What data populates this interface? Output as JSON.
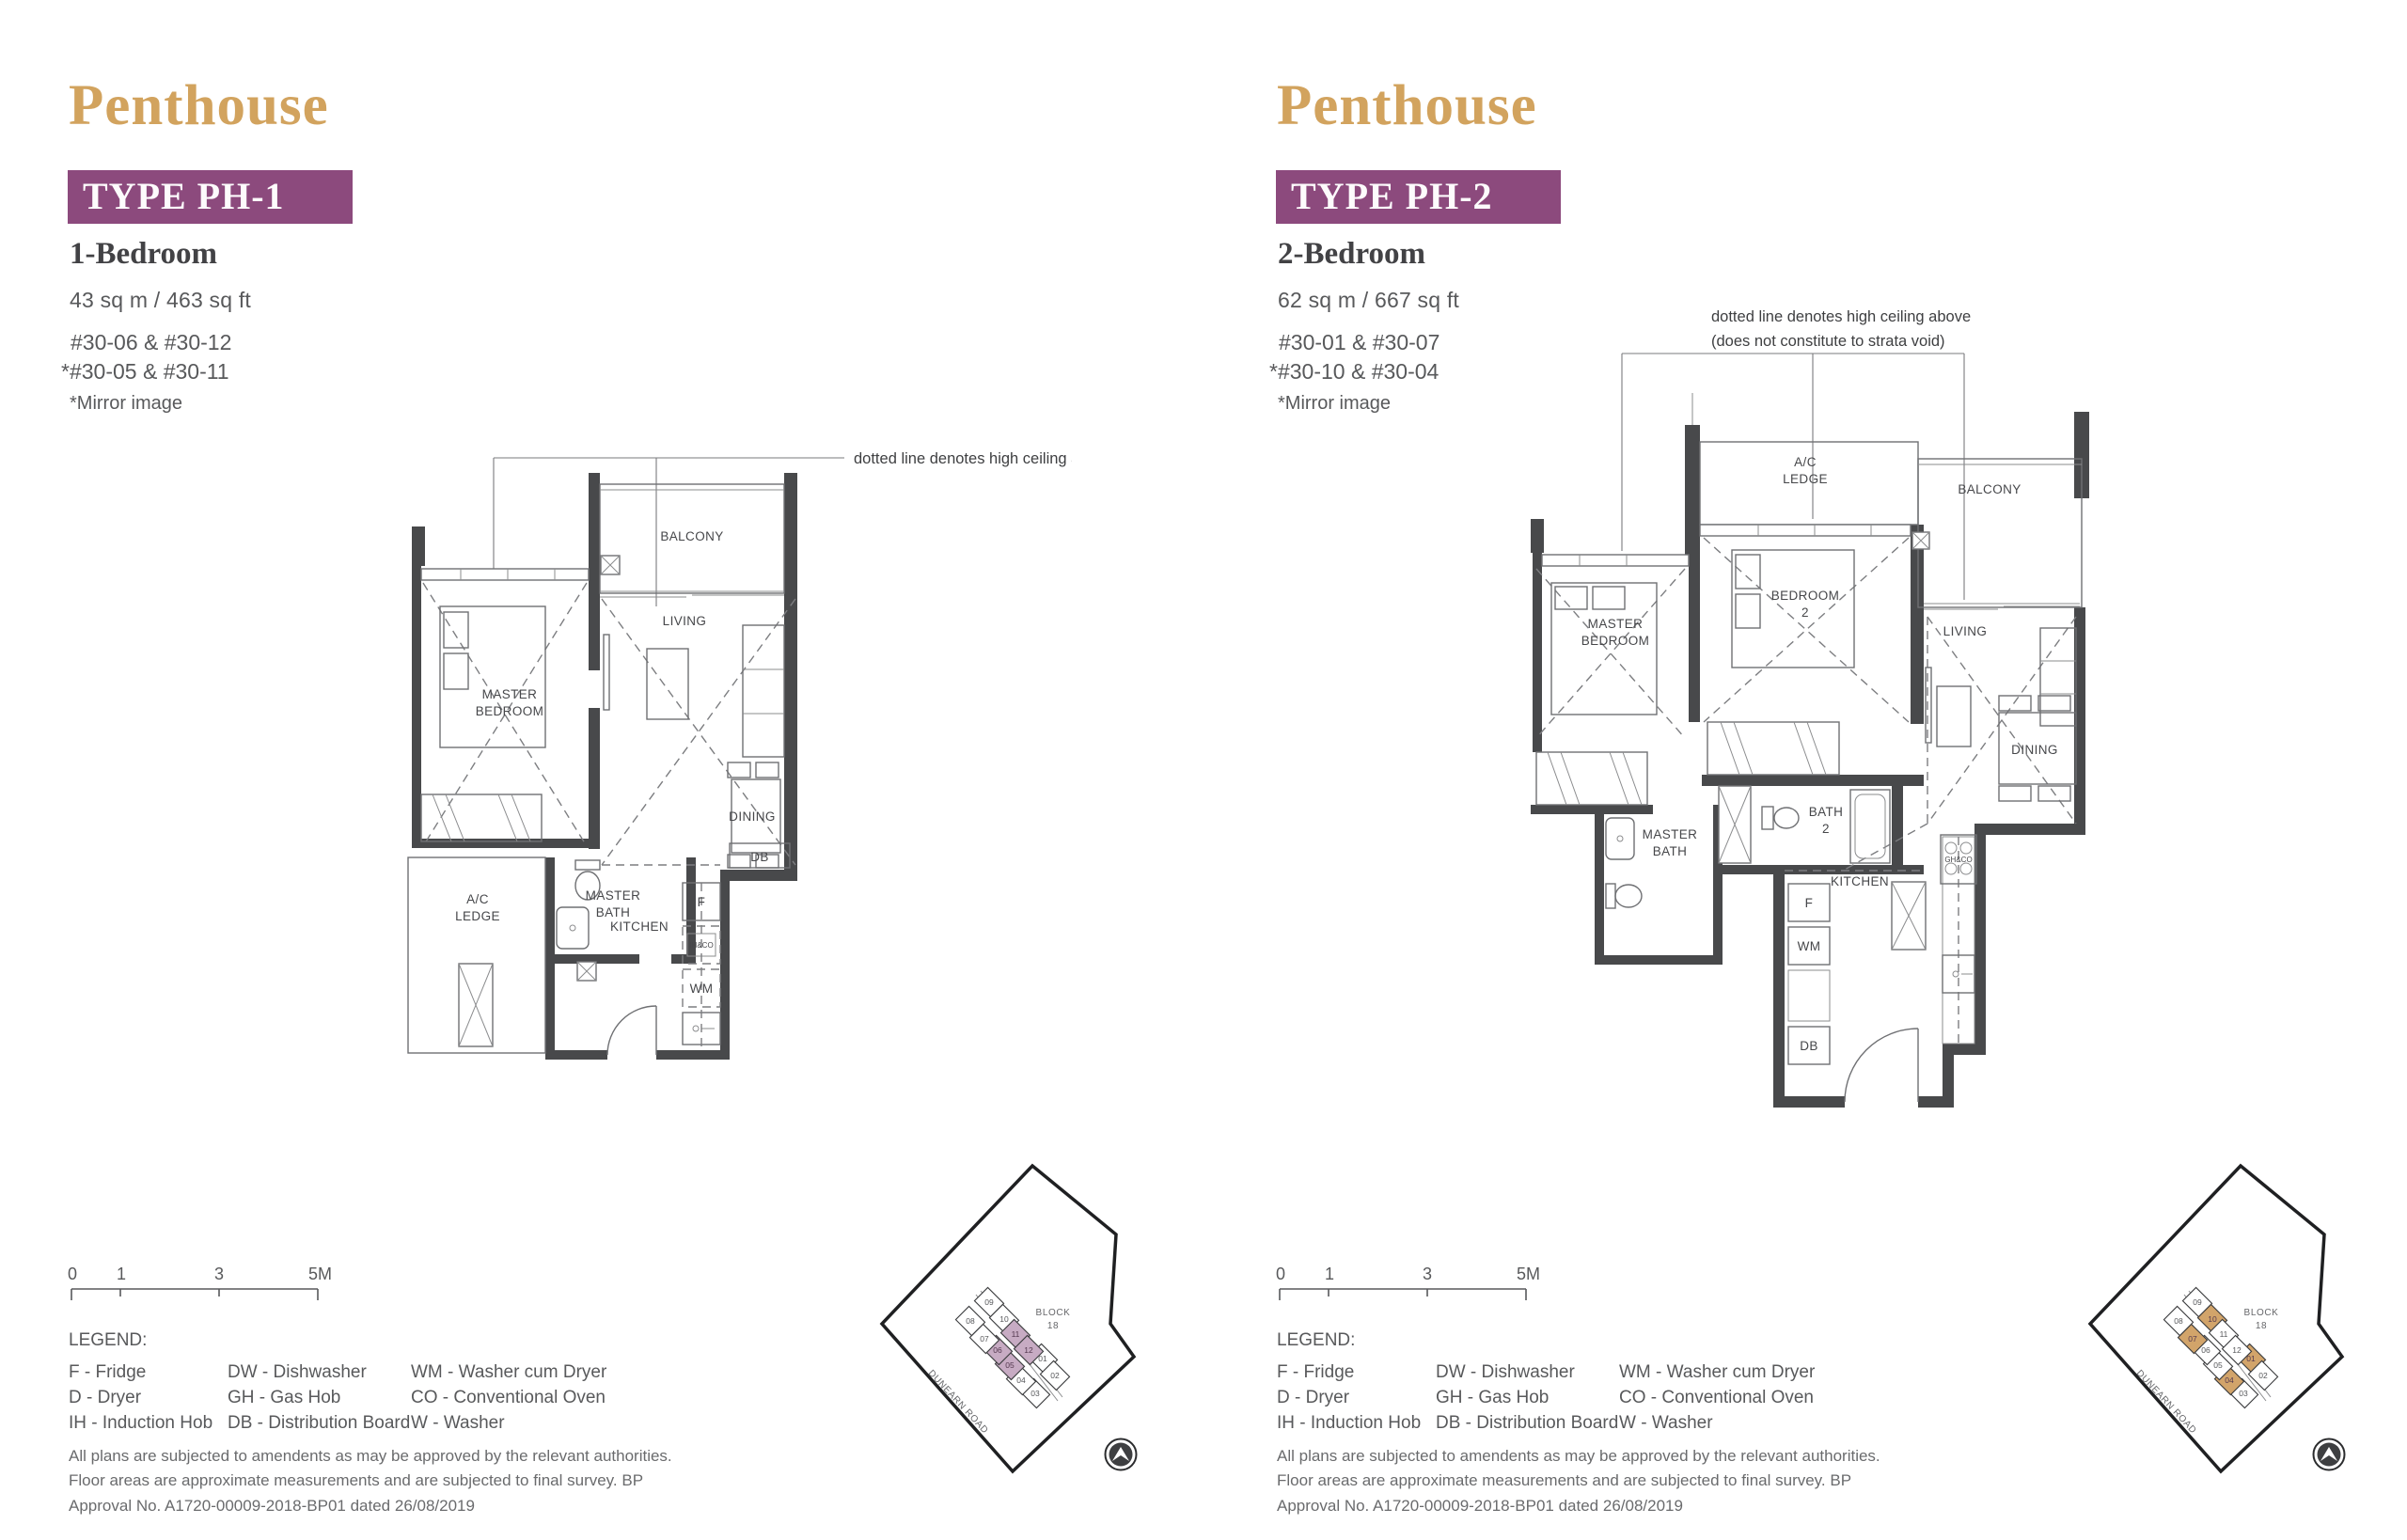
{
  "colors": {
    "accent_gold": "#d2a35e",
    "accent_purple": "#8c4a7d",
    "wall_gray": "#48494b",
    "text_gray": "#58595b",
    "ph1_highlight": "#c7abc3",
    "ph2_highlight": "#d2a46a"
  },
  "shared": {
    "scale_ticks": [
      "0",
      "1",
      "3",
      "5M"
    ],
    "legend_title": "LEGEND:",
    "legend_columns": [
      [
        "F - Fridge",
        "D - Dryer",
        "IH - Induction Hob"
      ],
      [
        "DW - Dishwasher",
        "GH - Gas Hob",
        "DB - Distribution Board"
      ],
      [
        "WM - Washer cum Dryer",
        "CO - Conventional Oven",
        "W - Washer"
      ]
    ],
    "disclaimer": "All plans are subjected to amendents as may be approved by the relevant authorities. Floor areas are approximate measurements and are subjected to final survey. BP Approval No. A1720-00009-2018-BP01 dated 26/08/2019",
    "sitemap": {
      "block_label": "BLOCK",
      "block_number": "18",
      "road": "DUNEARN ROAD",
      "unit_numbers": [
        "01",
        "02",
        "03",
        "04",
        "05",
        "06",
        "07",
        "08",
        "09",
        "10",
        "11",
        "12"
      ]
    }
  },
  "plans": [
    {
      "title": "Penthouse",
      "type_label": "TYPE PH-1",
      "bedroom_label": "1-Bedroom",
      "area": "43 sq m / 463 sq ft",
      "units_line1": "#30-06 & #30-12",
      "units_line2": "*#30-05 & #30-11",
      "mirror_note": "*Mirror image",
      "ceiling_note": [
        "dotted line denotes high ceiling above"
      ],
      "rooms": {
        "balcony": "BALCONY",
        "master_bedroom": [
          "MASTER",
          "BEDROOM"
        ],
        "living": "LIVING",
        "dining": "DINING",
        "db": "DB",
        "ac_ledge": [
          "A/C",
          "LEDGE"
        ],
        "master_bath": [
          "MASTER",
          "BATH"
        ],
        "kitchen": "KITCHEN",
        "fridge": "F",
        "hob": "IH&CO",
        "washer": "WM"
      },
      "sitemap_highlight_units": [
        "05",
        "06",
        "11",
        "12"
      ],
      "sitemap_highlight_color": "#c7abc3"
    },
    {
      "title": "Penthouse",
      "type_label": "TYPE PH-2",
      "bedroom_label": "2-Bedroom",
      "area": "62 sq m / 667 sq ft",
      "units_line1": "#30-01 & #30-07",
      "units_line2": "*#30-10 & #30-04",
      "mirror_note": "*Mirror image",
      "ceiling_note": [
        "dotted line denotes high ceiling above",
        "(does not constitute to strata void)"
      ],
      "rooms": {
        "ac_ledge": [
          "A/C",
          "LEDGE"
        ],
        "balcony": "BALCONY",
        "master_bedroom": [
          "MASTER",
          "BEDROOM"
        ],
        "bedroom2": [
          "BEDROOM",
          "2"
        ],
        "living": "LIVING",
        "dining": "DINING",
        "bath2": [
          "BATH",
          "2"
        ],
        "master_bath": [
          "MASTER",
          "BATH"
        ],
        "kitchen": "KITCHEN",
        "fridge": "F",
        "washer": "WM",
        "db": "DB",
        "hob": "GH&CO"
      },
      "sitemap_highlight_units": [
        "01",
        "04",
        "07",
        "10"
      ],
      "sitemap_highlight_color": "#d2a46a"
    }
  ]
}
